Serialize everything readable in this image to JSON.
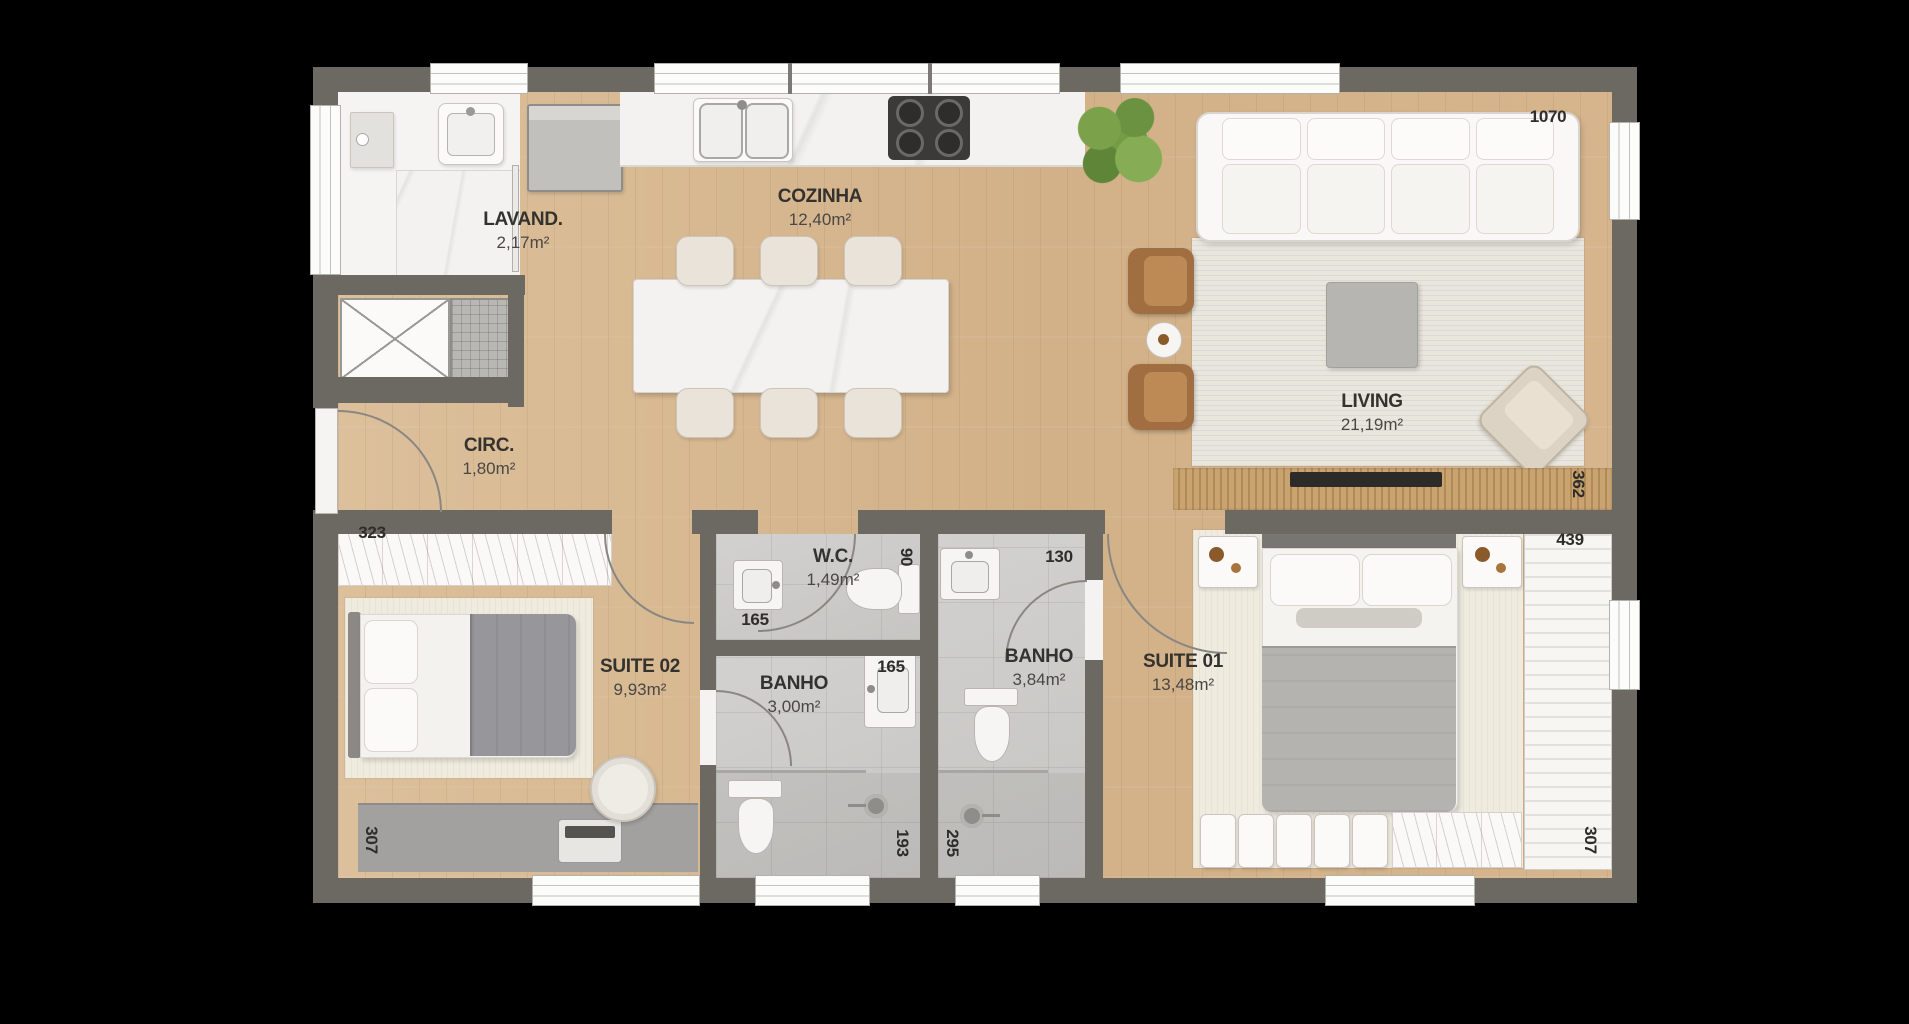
{
  "title": "Apartment floor plan",
  "rooms": {
    "lavanderia": {
      "name": "LAVAND.",
      "area": "2,17m²"
    },
    "cozinha": {
      "name": "COZINHA",
      "area": "12,40m²"
    },
    "living": {
      "name": "LIVING",
      "area": "21,19m²"
    },
    "circulacao": {
      "name": "CIRC.",
      "area": "1,80m²"
    },
    "suite02": {
      "name": "SUITE 02",
      "area": "9,93m²"
    },
    "banho_suite02": {
      "name": "BANHO",
      "area": "3,00m²"
    },
    "wc": {
      "name": "W.C.",
      "area": "1,49m²"
    },
    "banho_suite01": {
      "name": "BANHO",
      "area": "3,84m²"
    },
    "suite01": {
      "name": "SUITE 01",
      "area": "13,48m²"
    }
  },
  "dims": {
    "living_window": "1070",
    "panel_right": "362",
    "suite01_closet": "439",
    "suite01_right": "307",
    "suite02_closet": "323",
    "suite02_left": "307",
    "wc_vanity": "165",
    "wc_width": "90",
    "banho_suite01_width": "130",
    "banho_suite02_vanity": "165",
    "banho_suite02_shower": "193",
    "banho_suite01_shower": "295"
  },
  "colors": {
    "wall": "#6c6862",
    "wood": "#d6b78f",
    "rug_living": "#e9e6de",
    "rug_suite": "#efebdf",
    "text_dark": "#34322e",
    "text_area": "#4a4745",
    "armchair_brown": "#a06e41",
    "plant_green": "#749c46",
    "blanket_gray": "#b5b3af"
  }
}
